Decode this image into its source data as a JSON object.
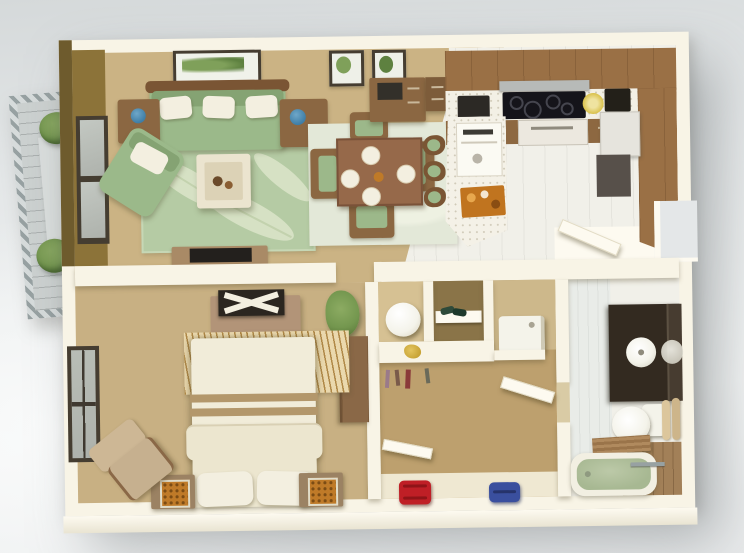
{
  "scene": {
    "type": "3d-floor-plan-render",
    "description": "Isometric 3D rendering of a one-bedroom apartment floor plan viewed from above, white cut-away walls on a gray studio background",
    "rooms": [
      {
        "name": "living-room",
        "furniture": [
          "green-sofa",
          "white-throw-pillows",
          "green-armchair",
          "leaf-pattern-rug",
          "coffee-table-with-tray",
          "side-table-left",
          "side-table-right",
          "tv-console",
          "flat-tv",
          "landscape-wall-art",
          "sliding-glass-door",
          "olive-accent-wall"
        ]
      },
      {
        "name": "dining-area",
        "furniture": [
          "square-dining-table",
          "four-place-settings",
          "four-dining-chairs",
          "pale-area-rug",
          "writing-desk",
          "file-cabinet",
          "two-small-framed-prints"
        ]
      },
      {
        "name": "kitchen",
        "furniture": [
          "l-shaped-wood-cabinets",
          "white-counter",
          "cooktop",
          "range-hood",
          "toaster",
          "coffee-maker",
          "yellow-dish",
          "refrigerator",
          "under-counter-unit",
          "island-with-sink",
          "orange-serving-tray",
          "three-bar-stools",
          "tile-floor",
          "entry-door-open"
        ]
      },
      {
        "name": "bedroom",
        "furniture": [
          "double-bed-white-linen",
          "two-pillows",
          "fan-pattern-headboard-rug",
          "nightstand-left",
          "nightstand-right",
          "orange-decor-boxes",
          "media-bench-with-tv",
          "potted-plant",
          "wardrobe",
          "lounge-chair",
          "window"
        ]
      },
      {
        "name": "hallway-closet",
        "furniture": [
          "water-heater-cylinder",
          "shoe-niche",
          "washing-machine",
          "storage-shelf",
          "gold-decor",
          "hanging-clothes",
          "open-bathroom-door",
          "open-bedroom-door",
          "red-duffel-bag",
          "blue-duffel-bag"
        ]
      },
      {
        "name": "bathroom",
        "furniture": [
          "dark-vanity",
          "round-vessel-sink",
          "mirror",
          "toilet",
          "towel-rack",
          "green-bathtub",
          "wood-bath-tray",
          "wood-deck-floor",
          "striped-tile-floor"
        ]
      },
      {
        "name": "balcony",
        "furniture": [
          "slatted-railing",
          "plank-floor",
          "shrub-planter-top",
          "shrub-planter-bottom"
        ]
      }
    ],
    "colors": {
      "bg_top": "#d5d9da",
      "bg_mid": "#e4e7e8",
      "bg_light": "#f3f5f5",
      "wall": "#f8f4e6",
      "wall_bright": "#fdfaf0",
      "wall_shade": "#e7dfc8",
      "olive": "#8c7339",
      "olive_dark": "#6e5b2d",
      "floor_tan": "#cbb384",
      "floor_bed": "#c8b083",
      "floor_closet": "#bda06e",
      "floor_strip": "#efe8d2",
      "tile": "#f1f0e9",
      "tile_line": "#e0dfd6",
      "rug_green": "#b5cba4",
      "rug_leaf": "#dae4c8",
      "rug_pale": "#e3e8d8",
      "sofa": "#9bb98a",
      "sofa_dark": "#85a373",
      "pillow": "#f3efe0",
      "seat": "#9cb88a",
      "wood": "#9a7045",
      "wood_dark": "#7a5534",
      "wood_mid": "#8b6742",
      "wood_tan": "#b29478",
      "counter": "#f3f0e5",
      "island": "#f4f1e7",
      "black": "#1d1b18",
      "steel": "#b7bab8",
      "fridge": "#e6e4dd",
      "unit_gray": "#57504a",
      "yellow": "#d9c14b",
      "bed": "#f1ecd9",
      "bed_low": "#ece6cf",
      "trim": "#b3976b",
      "fan": "#ead8ad",
      "fan_line": "#b08948",
      "night": "#9b8263",
      "orange": "#bf7a28",
      "chair_tan": "#c6b08f",
      "plant": "#74974f",
      "plant_dark": "#5c7c3c",
      "vanity": "#332a20",
      "mirror": "#473c30",
      "porcelain": "#f4f3ea",
      "towel": "#dcc69c",
      "tub": "#a7b892",
      "bath_wood": "#a28058",
      "rail": "#97a1a2",
      "slat": "#d6dbdb",
      "bal_floor": "#ccd1d0",
      "glass": "#aeb2ac",
      "frame_dark": "#453d31",
      "red": "#bf1f26",
      "blue": "#3a4f9e",
      "gold": "#c8a437",
      "art_green": "#7fa05a"
    }
  }
}
